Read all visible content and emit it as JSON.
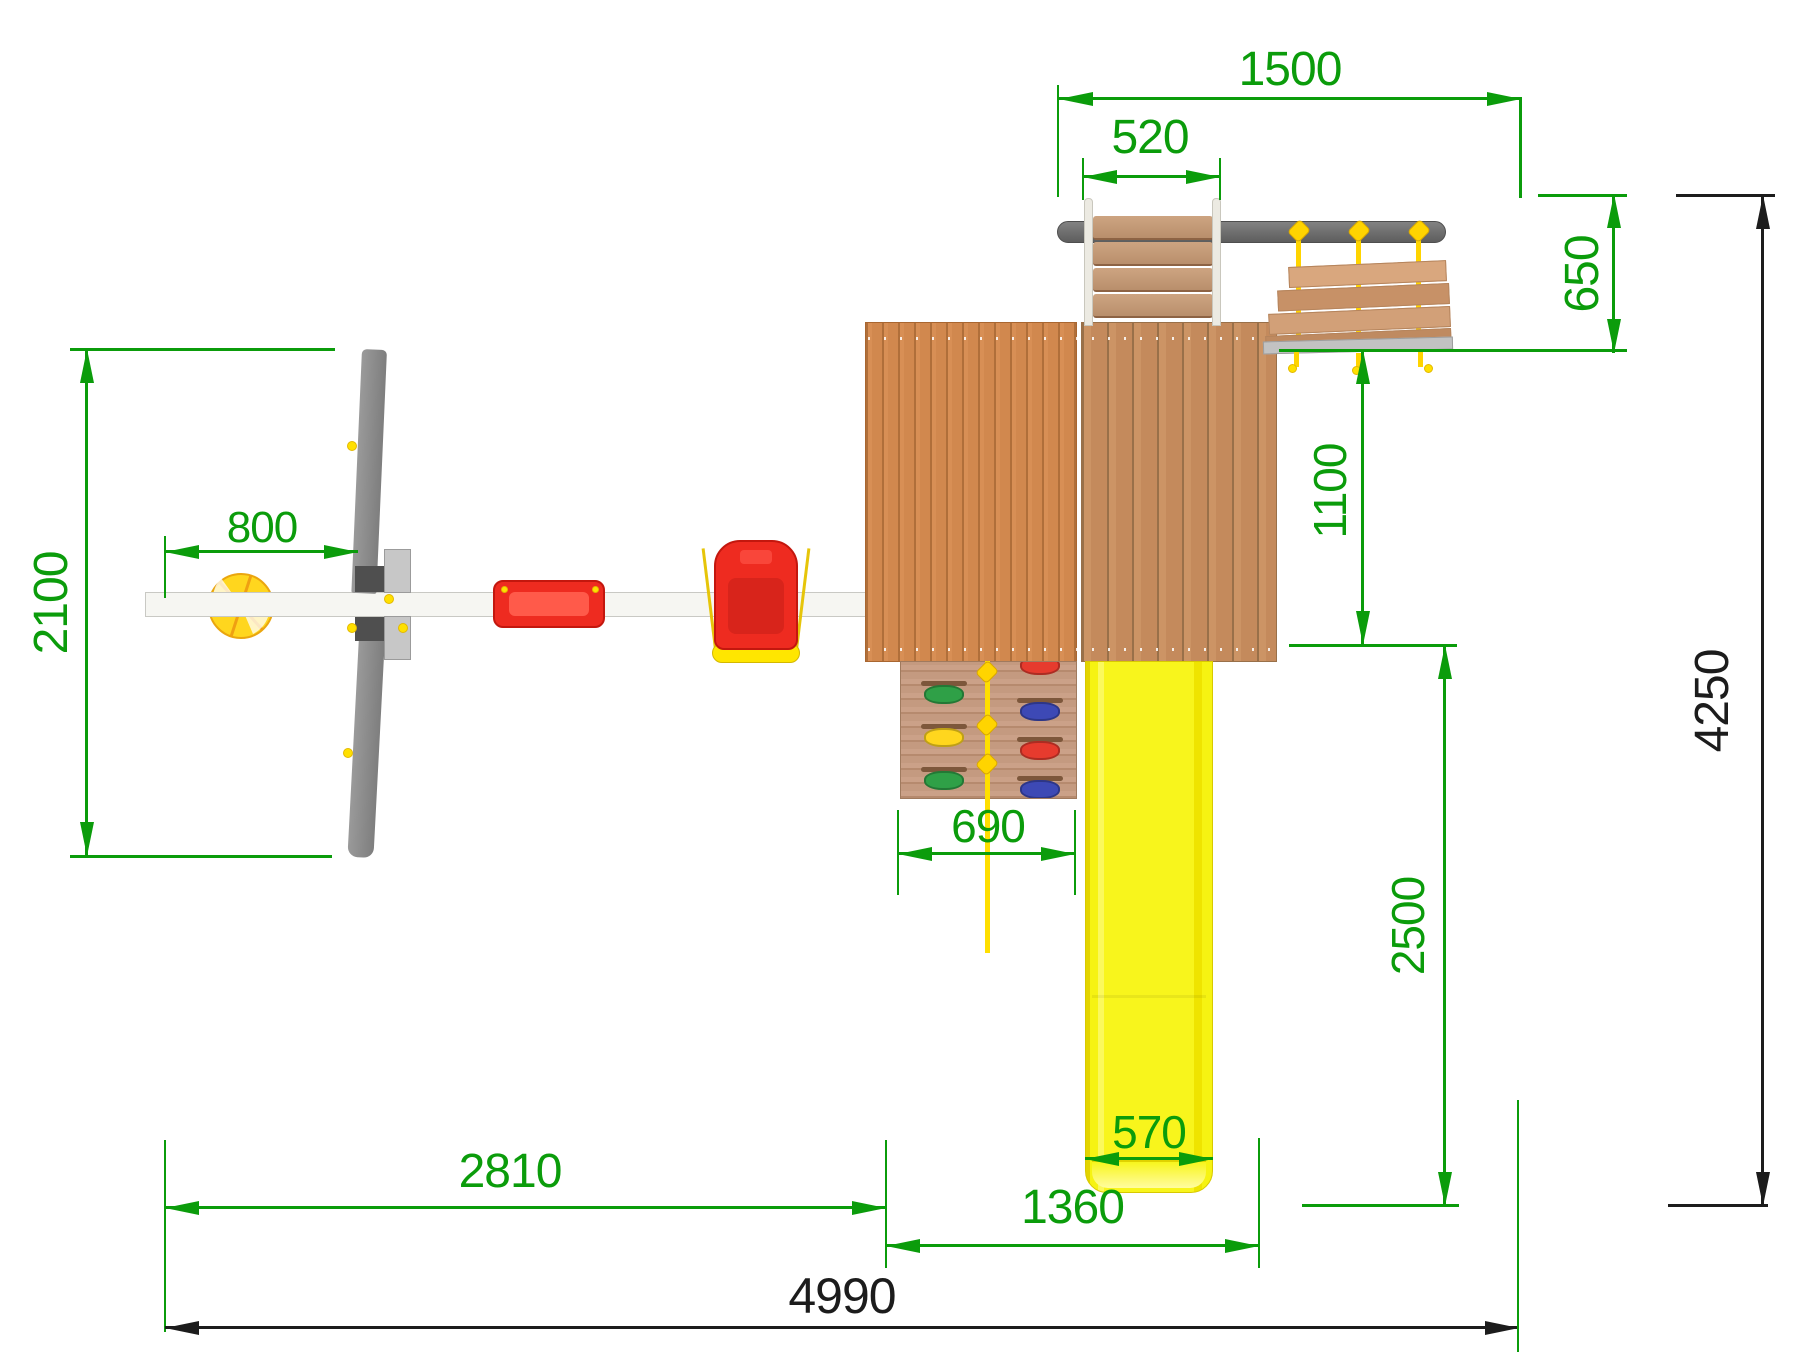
{
  "drawing": {
    "kind": "playground-top-view-dimension-drawing",
    "dimensions": {
      "monkey_beam_span": "1500",
      "ladder_width": "520",
      "bridge_depth": "650",
      "swing_frame_depth": "2100",
      "basketball_offset": "800",
      "platform_to_bridge_depth": "1100",
      "slide_runout_depth": "2500",
      "overall_depth": "4250",
      "climbing_wall_width": "690",
      "swing_section_width": "2810",
      "tower_section_width": "1360",
      "slide_width": "570",
      "overall_width": "4990"
    },
    "colors": {
      "dimension_green": "#0b9c0b",
      "dimension_black": "#1c1c1c",
      "slide_yellow": "#f8f51c",
      "rope_yellow": "#ffd400",
      "platform_wood": "#d1884e",
      "bridge_wood": "#d2a078",
      "metal_gray": "#8a8a8a",
      "beam_gray": "#6b6b6b",
      "seat_red": "#ee2b20",
      "hold_green": "#2fa047",
      "hold_yellow": "#ffd61e",
      "hold_red": "#e63b2e",
      "hold_blue": "#3d49b5",
      "ball_yellow": "#ffd61e"
    },
    "components": [
      "swing-beam",
      "basketball",
      "swing-a-frame-legs",
      "flat-swing-seat",
      "baby-swing-seat",
      "tower-platform",
      "access-ladder",
      "monkey-beam",
      "rope-bridge",
      "climbing-wall",
      "knotted-rope",
      "slide"
    ]
  }
}
